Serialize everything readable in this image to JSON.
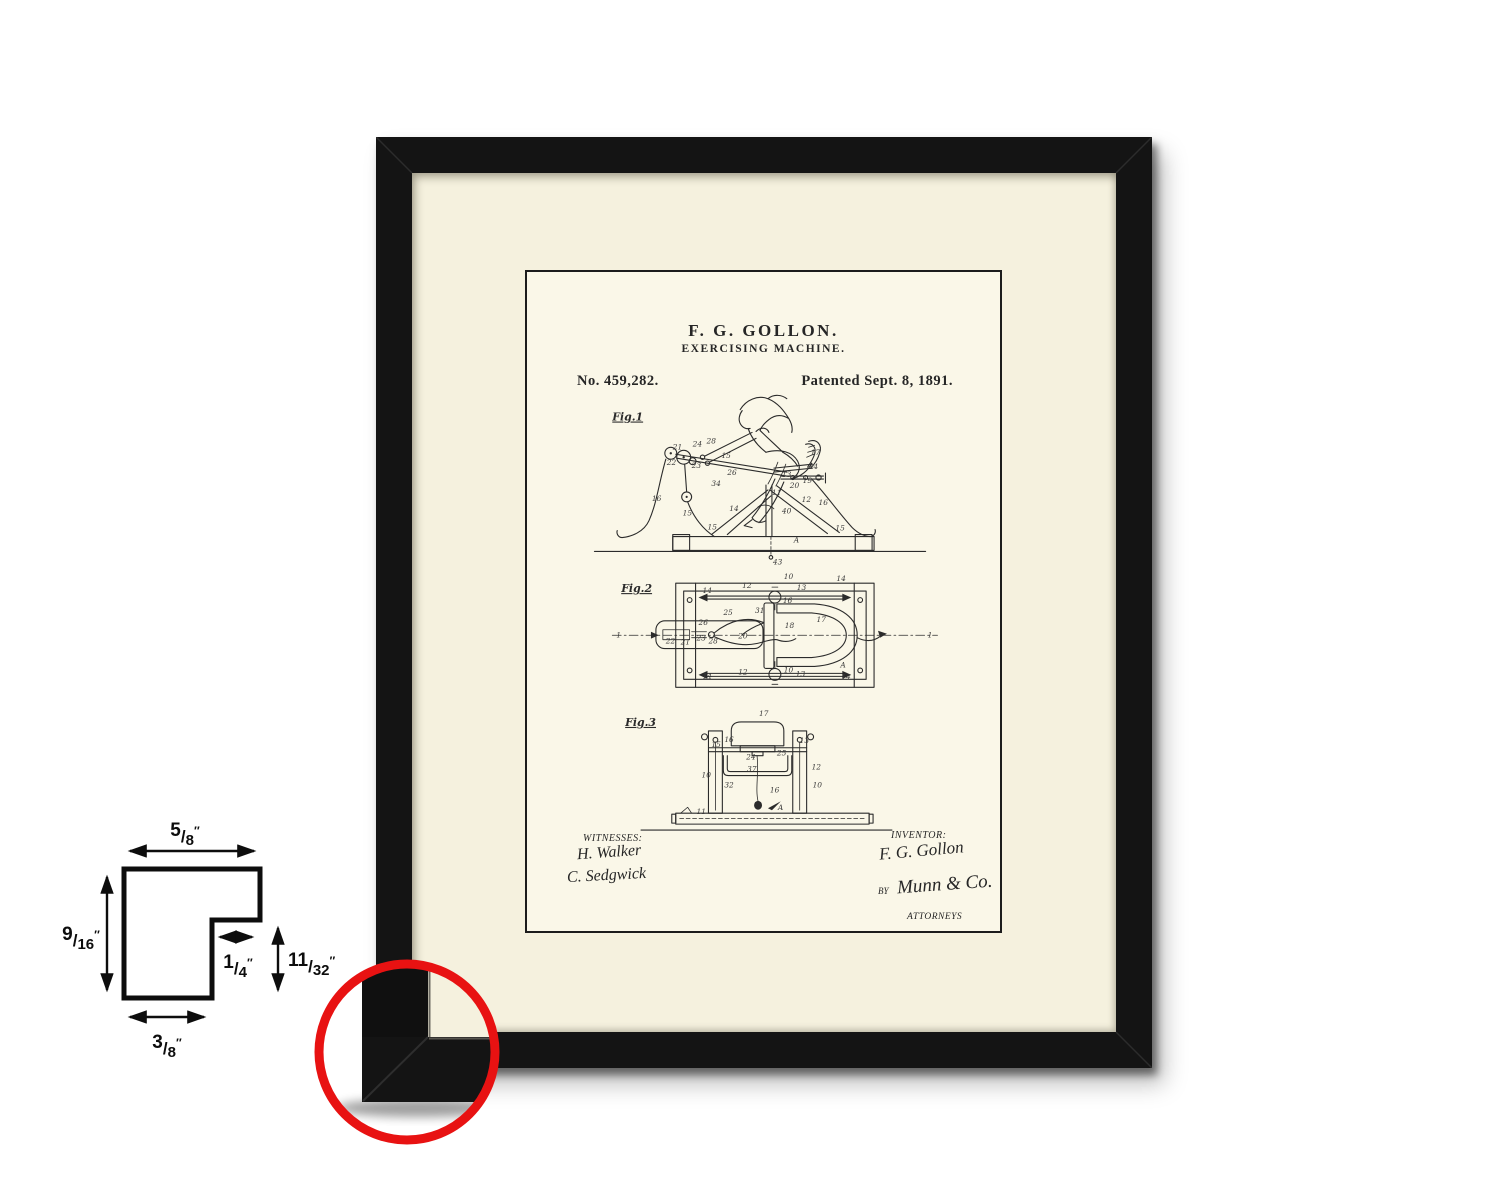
{
  "page": {
    "background": "#ffffff"
  },
  "frame": {
    "frame_color": "#141414",
    "mat_color": "#f5f1de",
    "paper_color": "#faf7e8",
    "detail_circle_color": "#e81212"
  },
  "patent": {
    "title": "F. G. GOLLON.",
    "subtitle": "EXERCISING MACHINE.",
    "number": "No. 459,282.",
    "date": "Patented Sept. 8, 1891.",
    "figures": {
      "fig1": "Fig.1",
      "fig2": "Fig.2",
      "fig3": "Fig.3"
    },
    "witnesses_label": "WITNESSES:",
    "witness_signature_1": "H. Walker",
    "witness_signature_2": "C. Sedgwick",
    "inventor_label": "INVENTOR:",
    "inventor_signature": "F. G. Gollon",
    "by_label": "BY",
    "attorney_signature": "Munn & Co.",
    "attorneys_label": "ATTORNEYS",
    "reference_numerals": [
      [
        147,
        178,
        "21"
      ],
      [
        141,
        194,
        "22"
      ],
      [
        167,
        175,
        "24"
      ],
      [
        181,
        172,
        "28"
      ],
      [
        196,
        187,
        "15"
      ],
      [
        166,
        197,
        "23"
      ],
      [
        202,
        204,
        "26"
      ],
      [
        186,
        215,
        "34"
      ],
      [
        286,
        184,
        "17"
      ],
      [
        284,
        198,
        "14"
      ],
      [
        257,
        206,
        "13"
      ],
      [
        278,
        212,
        "19"
      ],
      [
        265,
        217,
        "20"
      ],
      [
        247,
        224,
        "11"
      ],
      [
        126,
        230,
        "16"
      ],
      [
        157,
        245,
        "15"
      ],
      [
        277,
        231,
        "12"
      ],
      [
        294,
        234,
        "16"
      ],
      [
        257,
        243,
        "40"
      ],
      [
        204,
        240,
        "14"
      ],
      [
        182,
        259,
        "15"
      ],
      [
        311,
        260,
        "15"
      ],
      [
        269,
        272,
        "A"
      ],
      [
        248,
        294,
        "43"
      ],
      [
        259,
        309,
        "10"
      ],
      [
        177,
        323,
        "14"
      ],
      [
        217,
        318,
        "12"
      ],
      [
        272,
        320,
        "13"
      ],
      [
        312,
        311,
        "14"
      ],
      [
        258,
        333,
        "16"
      ],
      [
        230,
        343,
        "31"
      ],
      [
        198,
        345,
        "25"
      ],
      [
        173,
        355,
        "26"
      ],
      [
        292,
        352,
        "17"
      ],
      [
        260,
        358,
        "18"
      ],
      [
        140,
        374,
        "22"
      ],
      [
        155,
        375,
        "21"
      ],
      [
        171,
        371,
        "23"
      ],
      [
        183,
        374,
        "28"
      ],
      [
        213,
        369,
        "20"
      ],
      [
        90,
        368,
        "1"
      ],
      [
        404,
        368,
        "1"
      ],
      [
        316,
        398,
        "A"
      ],
      [
        259,
        403,
        "10"
      ],
      [
        213,
        405,
        "12"
      ],
      [
        271,
        407,
        "13"
      ],
      [
        177,
        409,
        "14"
      ],
      [
        317,
        410,
        "14"
      ],
      [
        234,
        447,
        "17"
      ],
      [
        199,
        473,
        "16"
      ],
      [
        186,
        478,
        "15"
      ],
      [
        275,
        474,
        "13"
      ],
      [
        221,
        491,
        "24"
      ],
      [
        252,
        487,
        "25"
      ],
      [
        222,
        503,
        "37"
      ],
      [
        287,
        501,
        "12"
      ],
      [
        176,
        509,
        "10"
      ],
      [
        288,
        519,
        "10"
      ],
      [
        199,
        519,
        "32"
      ],
      [
        245,
        524,
        "16"
      ],
      [
        171,
        546,
        "11"
      ],
      [
        253,
        542,
        "A"
      ]
    ]
  },
  "dimension_diagram": {
    "slash": "/",
    "unit": "″",
    "top_width": {
      "num": "5",
      "den": "8"
    },
    "left_height": {
      "num": "9",
      "den": "16"
    },
    "rabbet_width": {
      "num": "1",
      "den": "4"
    },
    "rabbet_height": {
      "num": "11",
      "den": "32"
    },
    "bottom_width": {
      "num": "3",
      "den": "8"
    }
  }
}
